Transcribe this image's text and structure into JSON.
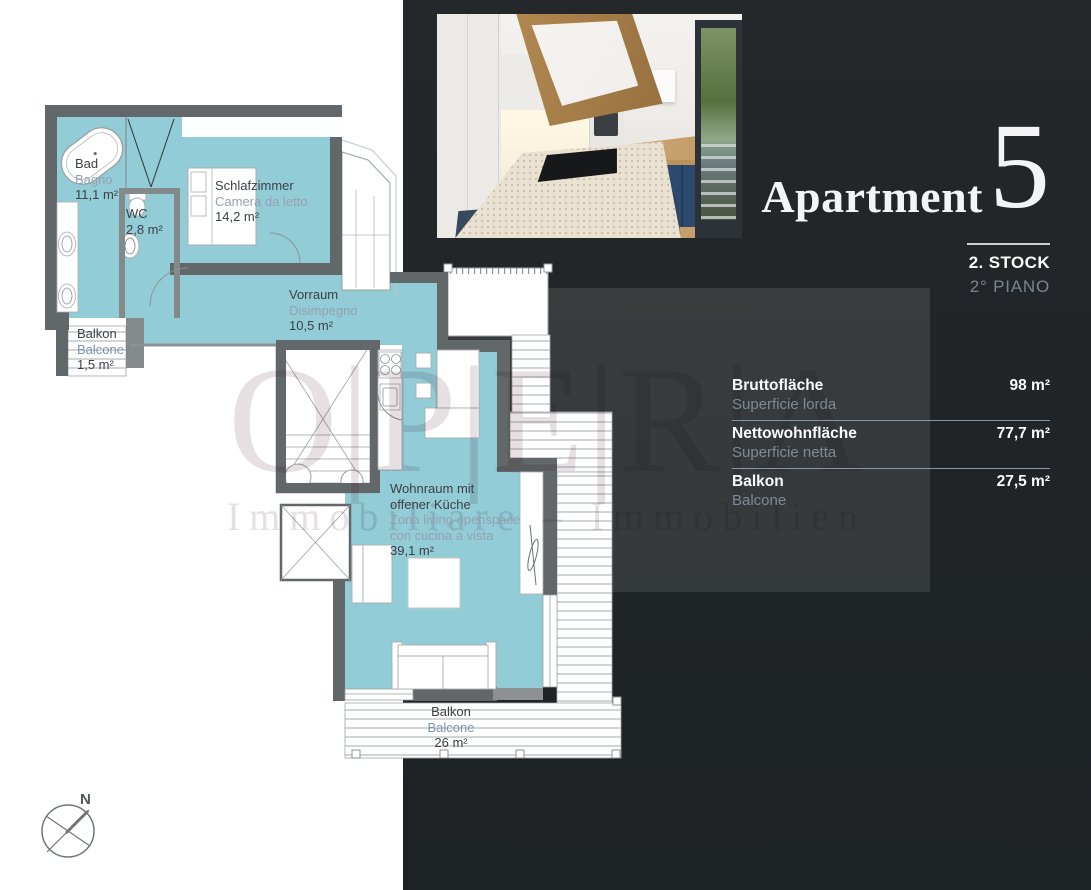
{
  "panel": {
    "title": "Apartment",
    "number": "5",
    "floor_de": "2. STOCK",
    "floor_it": "2° PIANO",
    "details": [
      {
        "label_de": "Bruttofläche",
        "label_it": "Superficie lorda",
        "value": "98 m²"
      },
      {
        "label_de": "Nettowohnfläche",
        "label_it": "Superficie netta",
        "value": "77,7 m²"
      },
      {
        "label_de": "Balkon",
        "label_it": "Balcone",
        "value": "27,5 m²"
      }
    ]
  },
  "watermark": {
    "letters": "O|P|E|R|A",
    "subtext": "Immobiliare – Immobilien"
  },
  "floorplan": {
    "compass_label": "N",
    "rooms": [
      {
        "id": "bad",
        "name": "Bad",
        "name_it": "Bagno",
        "area": "11,1 m²"
      },
      {
        "id": "wc",
        "name": "WC",
        "name_it": "",
        "area": "2,8 m²"
      },
      {
        "id": "schlafzimmer",
        "name": "Schlafzimmer",
        "name_it": "Camera da letto",
        "area": "14,2 m²"
      },
      {
        "id": "vorraum",
        "name": "Vorraum",
        "name_it": "Disimpegno",
        "area": "10,5 m²"
      },
      {
        "id": "balkon-klein",
        "name": "Balkon",
        "name_it": "Balcone",
        "area": "1,5 m²"
      },
      {
        "id": "wohnraum",
        "name": "Wohnraum mit",
        "name2": "offener Küche",
        "name_it": "Zona living openspace",
        "name_it2": "con cucina a vista",
        "area": "39,1 m²"
      },
      {
        "id": "balkon-gross",
        "name": "Balkon",
        "name_it": "Balcone",
        "area": "26 m²"
      }
    ]
  },
  "colors": {
    "room_fill": "#92ccd7",
    "wall": "#626769",
    "panel_bg": "#212527",
    "divider": "#8a99a8",
    "label_dark": "#3c4145",
    "label_muted": "#969fb3",
    "label_blue": "#7e92b6"
  }
}
